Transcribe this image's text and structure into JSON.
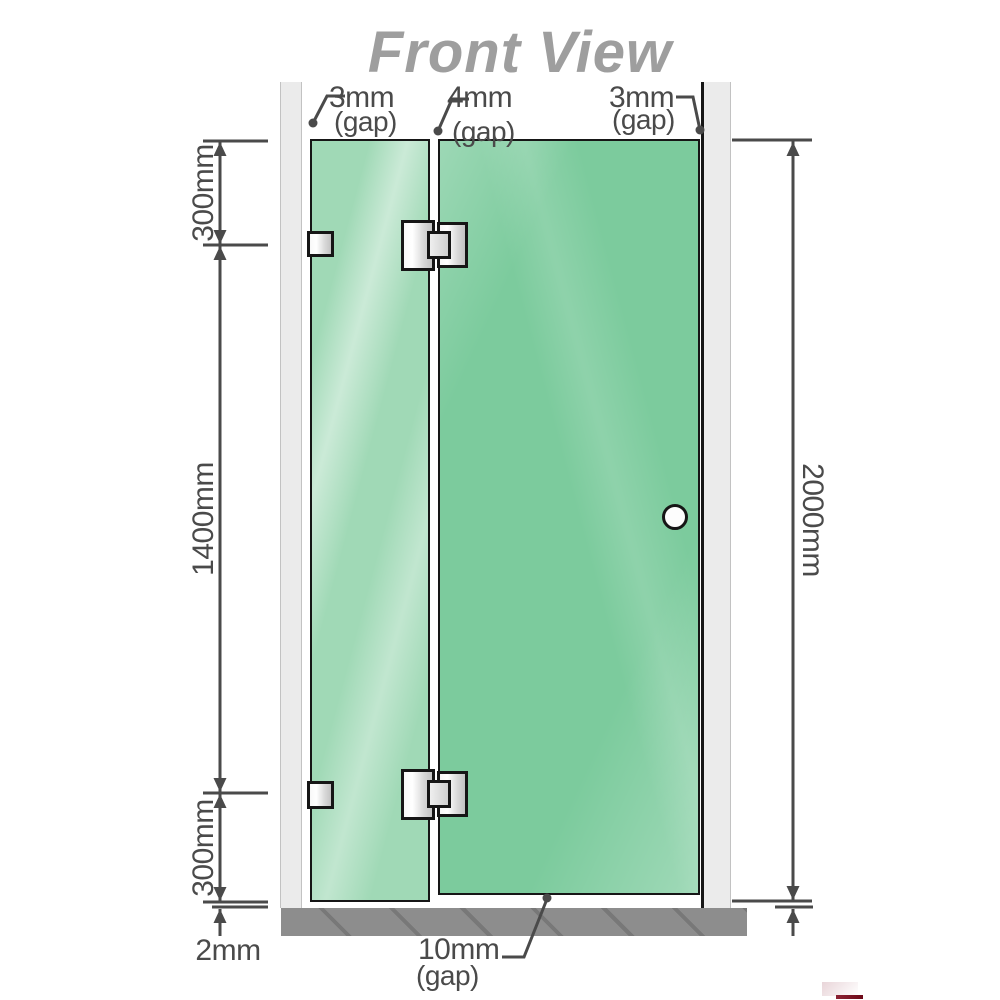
{
  "title": "Front View",
  "top_gaps": [
    {
      "value": "3mm",
      "note": "(gap)"
    },
    {
      "value": "4mm",
      "note": "(gap)"
    },
    {
      "value": "3mm",
      "note": "(gap)"
    }
  ],
  "left_dimensions": {
    "upper": "300mm",
    "middle": "1400mm",
    "lower": "300mm",
    "floor_gap": "2mm"
  },
  "right_dimension_total": "2000mm",
  "bottom_gap": {
    "value": "10mm",
    "note": "(gap)"
  },
  "colors": {
    "title": "#9e9e9e",
    "dimension": "#4a4a4a",
    "wall": "#ebebeb",
    "floor": "#8d8d8d",
    "glass_fixed": "#a0d9b6",
    "glass_door": "#7ccb9d",
    "outline": "#161616",
    "logo_red": "#6d0a18"
  }
}
